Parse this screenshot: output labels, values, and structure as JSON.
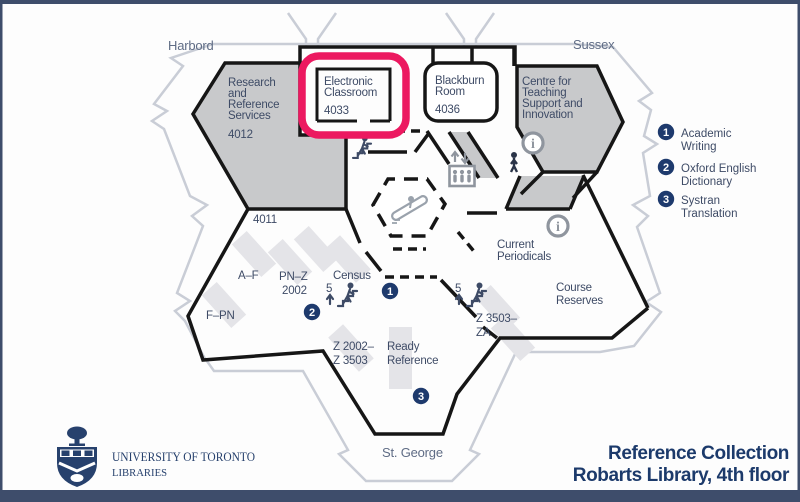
{
  "streets": {
    "harbord": "Harbord",
    "sussex": "Sussex",
    "st_george": "St. George"
  },
  "map": {
    "research": {
      "l1": "Research",
      "l2": "and",
      "l3": "Reference",
      "l4": "Services",
      "number": "4012"
    },
    "electronic": {
      "l1": "Electronic",
      "l2": "Classroom",
      "number": "4033"
    },
    "blackburn": {
      "l1": "Blackburn",
      "l2": "Room",
      "number": "4036"
    },
    "ctsi": {
      "l1": "Centre for",
      "l2": "Teaching",
      "l3": "Support and",
      "l4": "Innovation"
    },
    "room_4011": "4011",
    "current": {
      "l1": "Current",
      "l2": "Periodicals"
    },
    "course": {
      "l1": "Course",
      "l2": "Reserves"
    },
    "stacks": {
      "af": "A–F",
      "pnz1": "PN–Z",
      "pnz2": "2002",
      "fpn": "F–PN",
      "census": "Census",
      "z2002a": "Z 2002–",
      "z2002b": "Z 3503",
      "ready1": "Ready",
      "ready2": "Reference",
      "z3503a": "Z 3503–",
      "z3503b": "ZA"
    },
    "stair_floor": "5",
    "badges": {
      "b1": "1",
      "b2": "2",
      "b3": "3"
    },
    "info_symbol": "i"
  },
  "legend": {
    "items": [
      {
        "num": "1",
        "l1": "Academic",
        "l2": "Writing"
      },
      {
        "num": "2",
        "l1": "Oxford English",
        "l2": "Dictionary"
      },
      {
        "num": "3",
        "l1": "Systran",
        "l2": "Translation"
      }
    ]
  },
  "logo": {
    "institution": "UNIVERSITY OF TORONTO",
    "division": "LIBRARIES"
  },
  "title": {
    "l1": "Reference Collection",
    "l2": "Robarts Library, 4th floor"
  },
  "colors": {
    "highlight_pink": "#ec1960",
    "navy": "#1c3a6b",
    "badge_navy": "#1e3a6d",
    "room_gray": "#c8c9cb",
    "shelf_gray": "#e4e4e8",
    "boundary_gray": "#c9cdd6",
    "wall_black": "#161616",
    "icon_gray": "#8f959e",
    "frame": "#3e4d6b"
  }
}
